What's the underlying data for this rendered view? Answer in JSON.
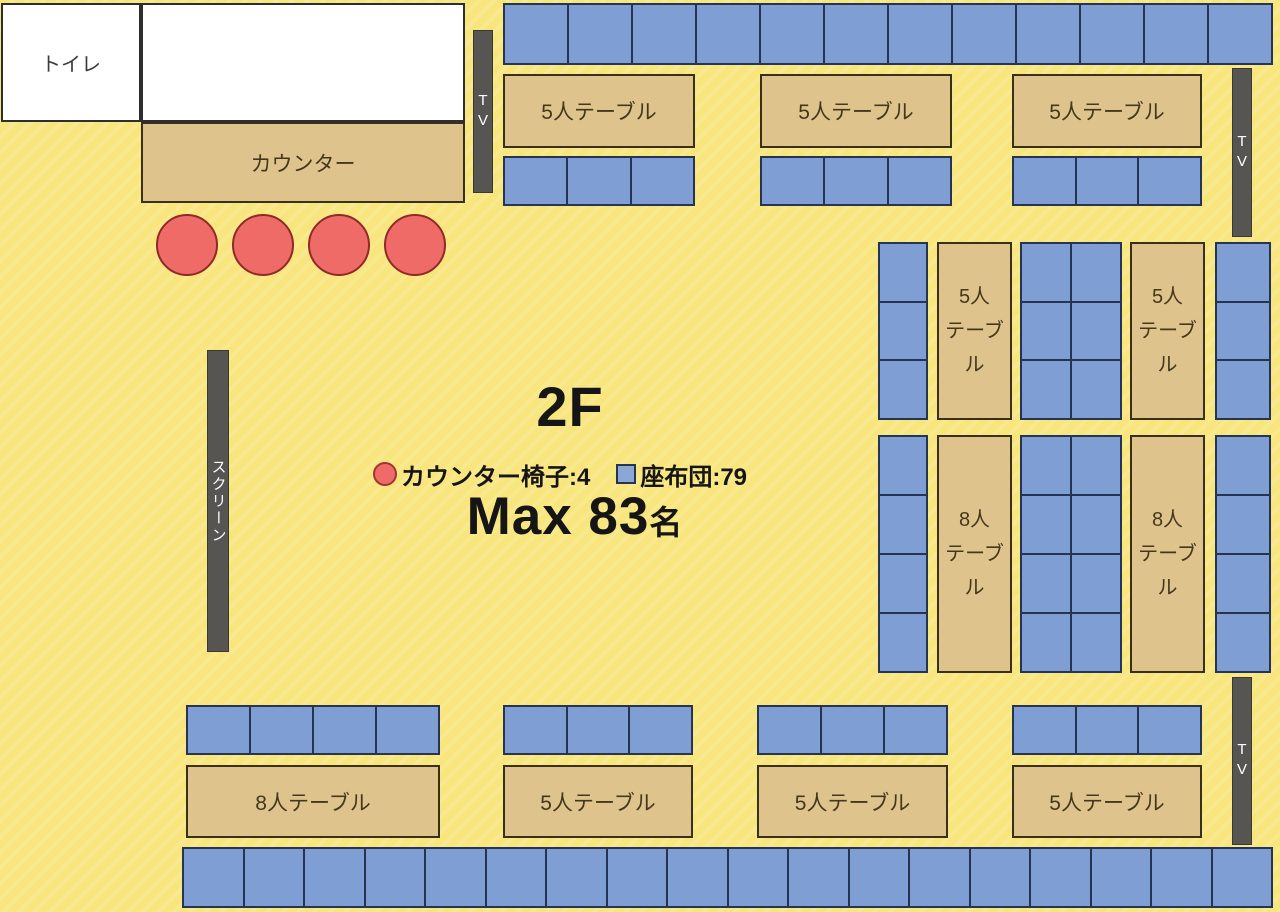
{
  "floor": {
    "title": "2F",
    "max_people": "Max 83",
    "max_suffix": "名",
    "legend": {
      "chairs": "カウンター椅子:4",
      "cushions": "座布団:79"
    }
  },
  "rooms": {
    "toilet": "トイレ",
    "counter": "カウンター"
  },
  "fixtures": {
    "tv": "TV",
    "screen": "スクリーン"
  },
  "tables": {
    "five_h": "5人テーブル",
    "eight_h": "8人テーブル",
    "five_line1": "5人",
    "eight_line1": "8人",
    "line2": "テーブル"
  },
  "counts": {
    "counter_chairs": 4,
    "top_strip": 12,
    "top_table1_row": 3,
    "top_table2_row": 3,
    "top_table3_row": 3,
    "right1_left_col": 3,
    "right1_mid_grid": 6,
    "right1_right_col": 3,
    "right2_left_col": 4,
    "right2_mid_grid": 8,
    "right2_right_col": 4,
    "bottom_table8_row": 4,
    "bottom_table1_row": 3,
    "bottom_table2_row": 3,
    "bottom_table3_row": 3,
    "bottom_strip": 18
  },
  "colors": {
    "floor_yellow": "#F8E57D",
    "cushion_blue": "#7F9ED3",
    "table_tan": "#DFC38C",
    "chair_red": "#EF6B67",
    "fixture_gray": "#575551"
  }
}
